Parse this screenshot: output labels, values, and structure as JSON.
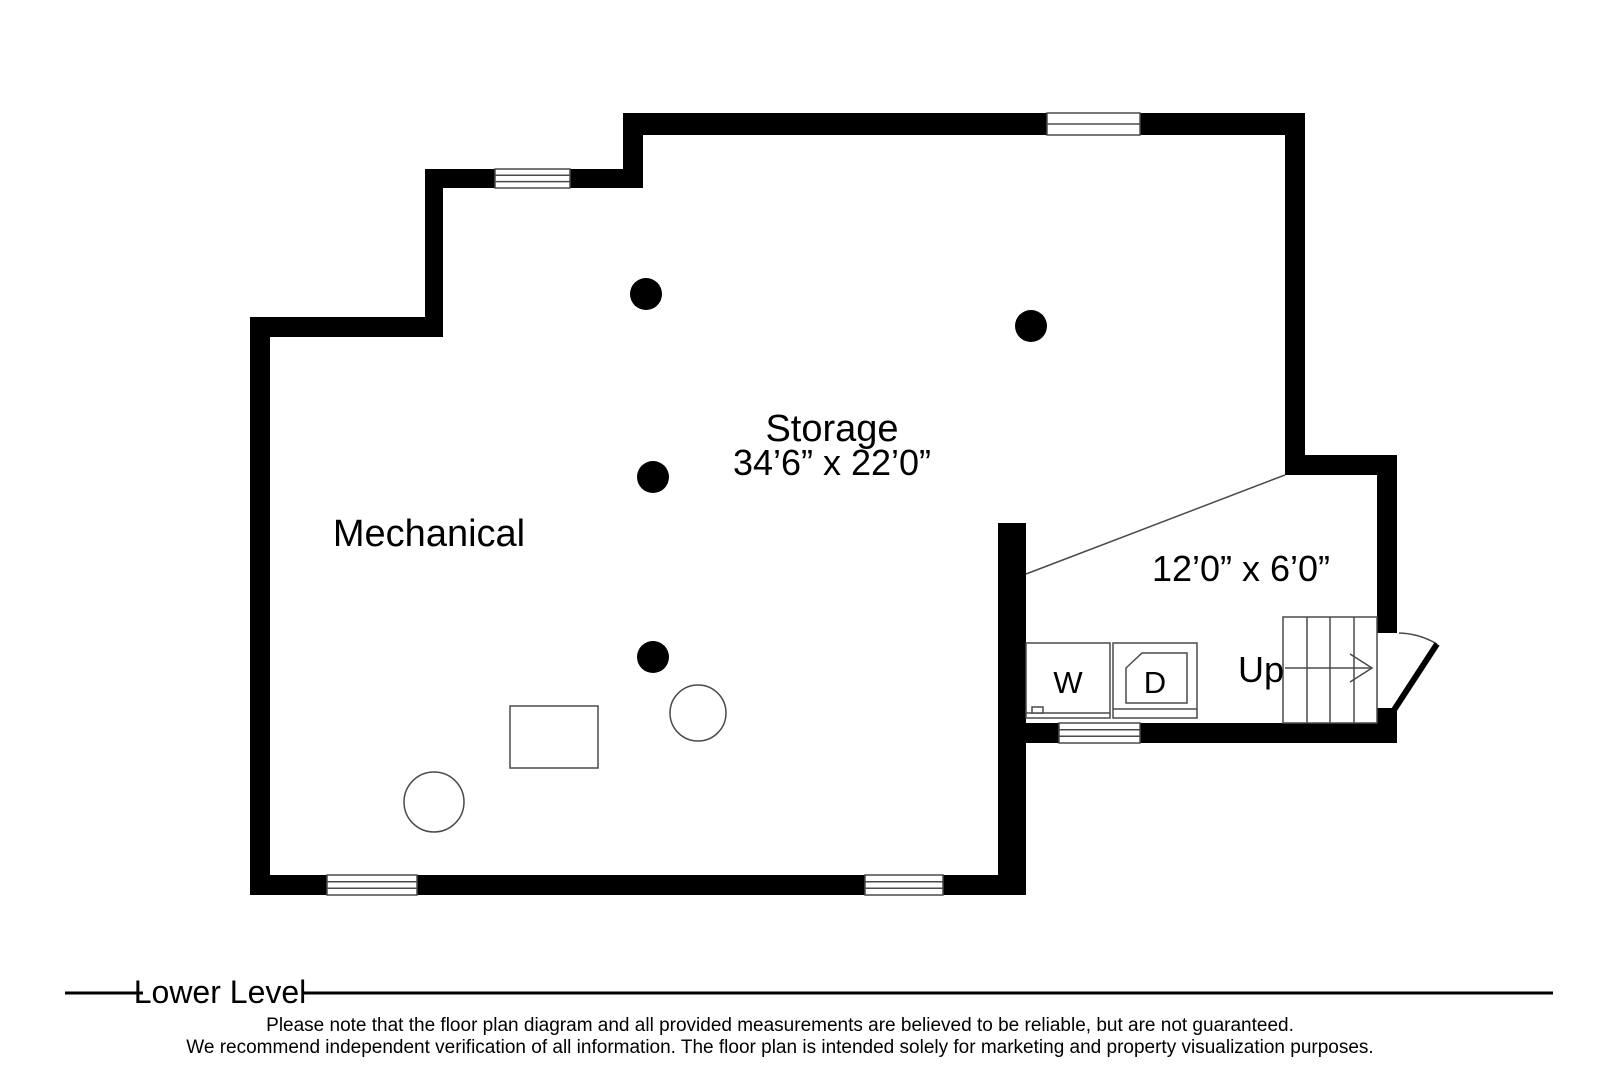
{
  "plan": {
    "rooms": {
      "storage": {
        "name": "Storage",
        "dimensions": "34’6” x 22’0”"
      },
      "mechanical": {
        "name": "Mechanical"
      },
      "laundry": {
        "dimensions": "12’0” x 6’0”"
      }
    },
    "fixtures": {
      "washer_label": "W",
      "dryer_label": "D",
      "stairs_direction_label": "Up"
    }
  },
  "footer": {
    "level_label": "Lower Level",
    "disclaimer_line1": "Please note that the floor plan diagram and all provided measurements are believed to be reliable, but are not guaranteed.",
    "disclaimer_line2": "We recommend independent verification of all information. The floor plan is intended solely for marketing and property visualization purposes."
  },
  "colors": {
    "wall": "#000000",
    "thin_line": "#4a4a4a",
    "text": "#000000",
    "background": "#ffffff"
  }
}
